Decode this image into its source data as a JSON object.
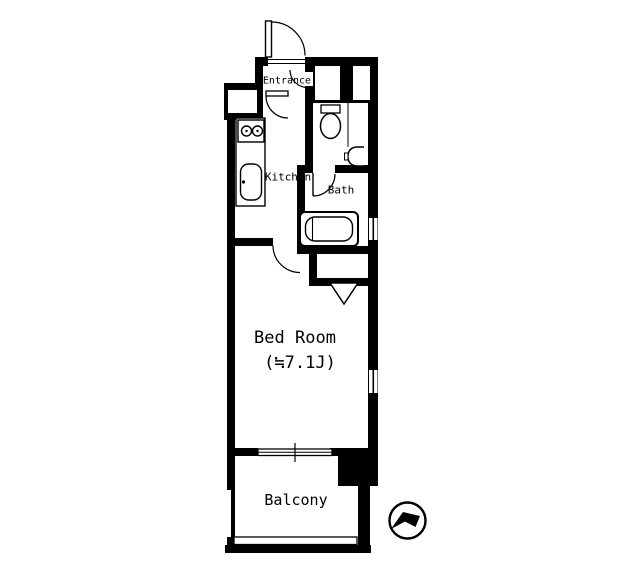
{
  "floorplan": {
    "type": "apartment-floor-plan-1K",
    "labels": {
      "entrance": "Entrance",
      "kitchen": "Kitchen",
      "bath": "Bath",
      "bedroom": "Bed Room",
      "bedroom_size": "(≒7.1J)",
      "balcony": "Balcony"
    },
    "icons": {
      "compass": "north-arrow"
    },
    "colors": {
      "wall": "#000000",
      "floor": "#ffffff",
      "line": "#000000"
    }
  }
}
